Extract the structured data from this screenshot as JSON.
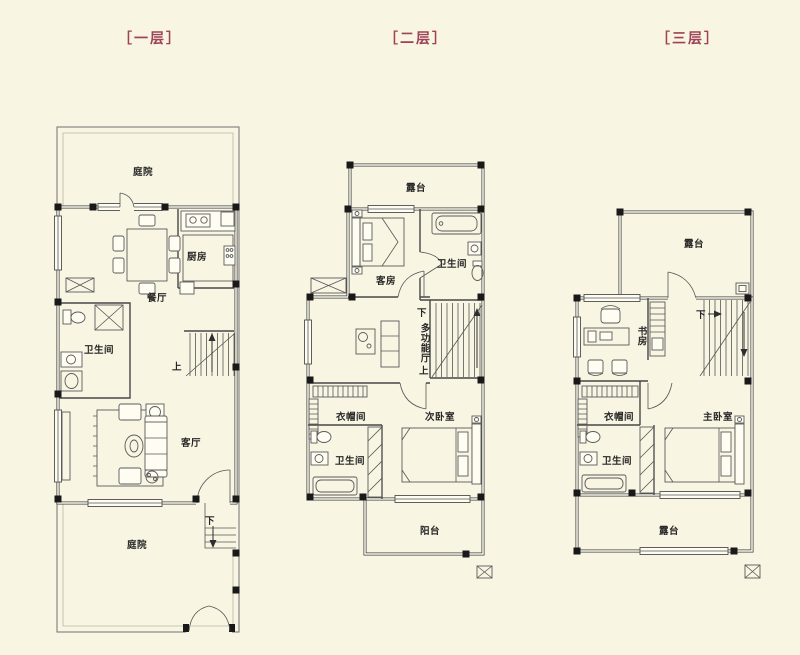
{
  "page": {
    "background": "#f9f5e3",
    "accent": "#9e4257",
    "line_color": "#3d3d3d"
  },
  "floors": [
    {
      "title": "［一层］",
      "rooms": {
        "courtyard_top": "庭院",
        "dining": "餐厅",
        "kitchen": "厨房",
        "bathroom": "卫生间",
        "living": "客厅",
        "courtyard_bottom": "庭院"
      },
      "stairs": {
        "up": "上",
        "down": "下"
      }
    },
    {
      "title": "［二层］",
      "rooms": {
        "terrace": "露台",
        "guest_room": "客房",
        "bathroom_top": "卫生间",
        "multi_hall": "多功能厅",
        "cloakroom": "衣帽间",
        "second_bedroom": "次卧室",
        "bathroom_bottom": "卫生间",
        "balcony": "阳台"
      },
      "stairs": {
        "down": "下",
        "up": "上"
      }
    },
    {
      "title": "［三层］",
      "rooms": {
        "terrace_top": "露台",
        "study": "书房",
        "cloakroom": "衣帽间",
        "master_bedroom": "主卧室",
        "bathroom": "卫生间",
        "terrace_bottom": "露台"
      },
      "stairs": {
        "down": "下"
      }
    }
  ]
}
